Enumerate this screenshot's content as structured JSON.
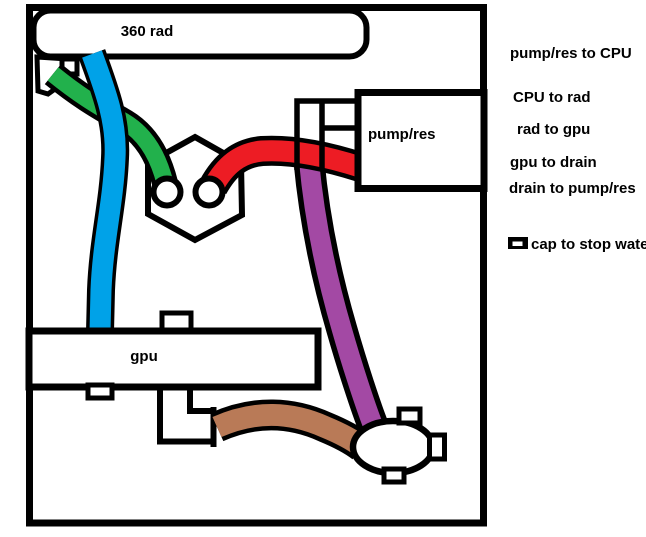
{
  "diagram": {
    "title_context": "watercooling-loop-sketch",
    "components": {
      "radiator_label": "360 rad",
      "pump_label": "pump/res",
      "gpu_label": "gpu"
    },
    "legend": {
      "items": [
        {
          "label": "pump/res to CPU",
          "color": "#ED1C46"
        },
        {
          "label": "CPU to rad",
          "color": "#22B14C"
        },
        {
          "label": "rad to gpu",
          "color": "#00A2E8"
        },
        {
          "label": "gpu to drain",
          "color": "#B97A57"
        },
        {
          "label": "drain to pump/res",
          "color": "#A349A4"
        }
      ],
      "cap_note": {
        "label": "cap to stop water",
        "color": "#000000"
      }
    },
    "tube_colors": {
      "pump_to_cpu": "#ED1C24",
      "cpu_to_rad": "#22B14C",
      "rad_to_gpu": "#00A2E8",
      "gpu_to_drain": "#B97A57",
      "drain_to_pump": "#A349A4"
    },
    "outline_color": "#000000",
    "background_color": "#FFFFFF"
  }
}
